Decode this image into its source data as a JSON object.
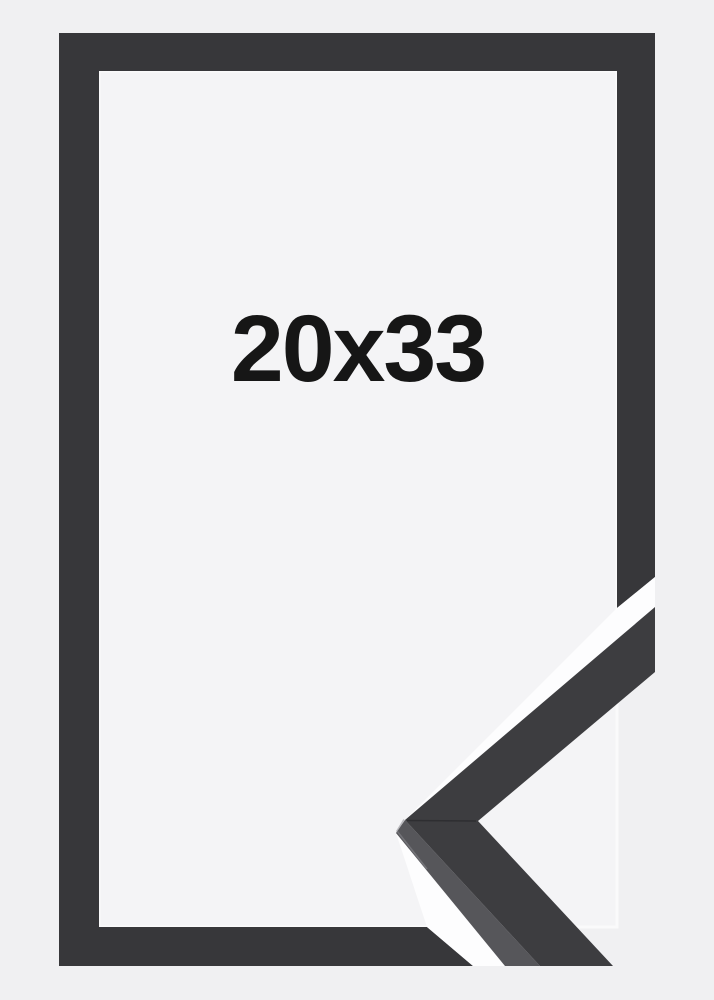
{
  "product_image": {
    "size_label": "20x33"
  },
  "colors": {
    "background": "#f0f0f2",
    "panel": "#f4f4f6",
    "panel_edge_highlight": "#fafafb",
    "frame": "#37373a",
    "corner_face": "#3d3d40",
    "corner_side": "#56565a",
    "corner_seam": "#2c2c2f",
    "corner_tip_highlight": "#8a8a8f",
    "gap_white": "#fdfdfe",
    "label_text": "#161616"
  }
}
